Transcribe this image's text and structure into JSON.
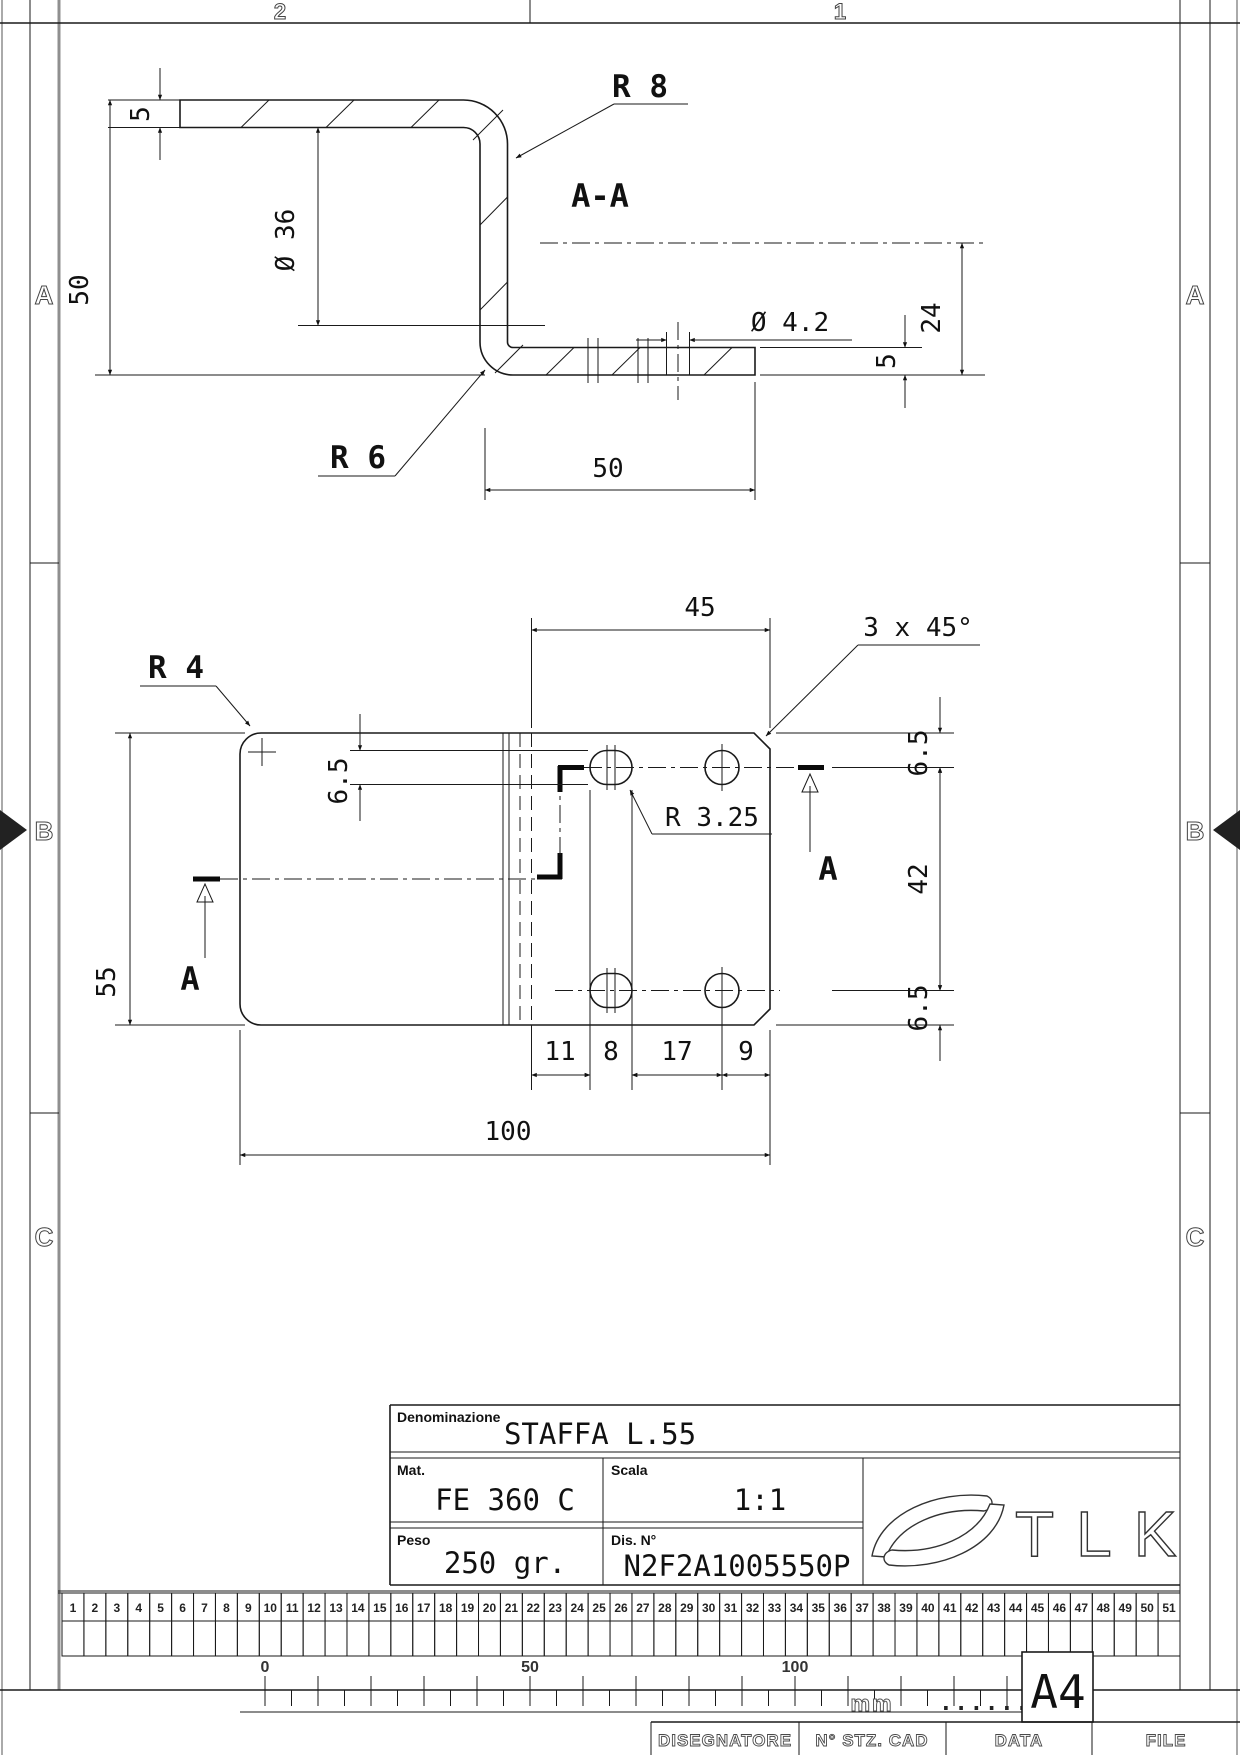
{
  "sheet": {
    "zone_numbers": [
      "2",
      "1"
    ],
    "zone_letters": [
      "A",
      "B",
      "C"
    ],
    "format_label": "A4",
    "scale_ruler": {
      "labels": [
        "0",
        "50",
        "100"
      ],
      "unit": "mm",
      "dots": "......"
    },
    "index_ruler": {
      "cells": [
        "1",
        "2",
        "3",
        "4",
        "5",
        "6",
        "7",
        "8",
        "9",
        "10",
        "11",
        "12",
        "13",
        "14",
        "15",
        "16",
        "17",
        "18",
        "19",
        "20",
        "21",
        "22",
        "23",
        "24",
        "25",
        "26",
        "27",
        "28",
        "29",
        "30",
        "31",
        "32",
        "33",
        "34",
        "35",
        "36",
        "37",
        "38",
        "39",
        "40",
        "41",
        "42",
        "43",
        "44",
        "45",
        "46",
        "47",
        "48",
        "49",
        "50",
        "51"
      ]
    },
    "footer": {
      "columns": [
        "DISEGNATORE",
        "N° STZ. CAD",
        "DATA",
        "FILE"
      ]
    }
  },
  "title_block": {
    "denominazione_label": "Denominazione",
    "denominazione": "STAFFA L.55",
    "mat_label": "Mat.",
    "mat": "FE 360 C",
    "scala_label": "Scala",
    "scala": "1:1",
    "peso_label": "Peso",
    "peso": "250 gr.",
    "dis_label": "Dis. N°",
    "dis": "N2F2A1005550P",
    "logo_text": "TLK"
  },
  "section_view": {
    "label": "A-A",
    "dims": {
      "r8": "R 8",
      "t_top": "5",
      "h_total": "50",
      "d36": "Ø 36",
      "d42": "Ø 4.2",
      "h24": "24",
      "t_right": "5",
      "r6": "R 6",
      "w50": "50"
    }
  },
  "plan_view": {
    "cut_label": "A",
    "dims": {
      "w45": "45",
      "chamfer": "3 x 45°",
      "r4": "R 4",
      "slot_h": "6.5",
      "r325": "R 3.25",
      "off_top": "6.5",
      "v42": "42",
      "off_bot": "6.5",
      "h55": "55",
      "d11": "11",
      "d8": "8",
      "d17": "17",
      "d9": "9",
      "w100": "100"
    }
  }
}
